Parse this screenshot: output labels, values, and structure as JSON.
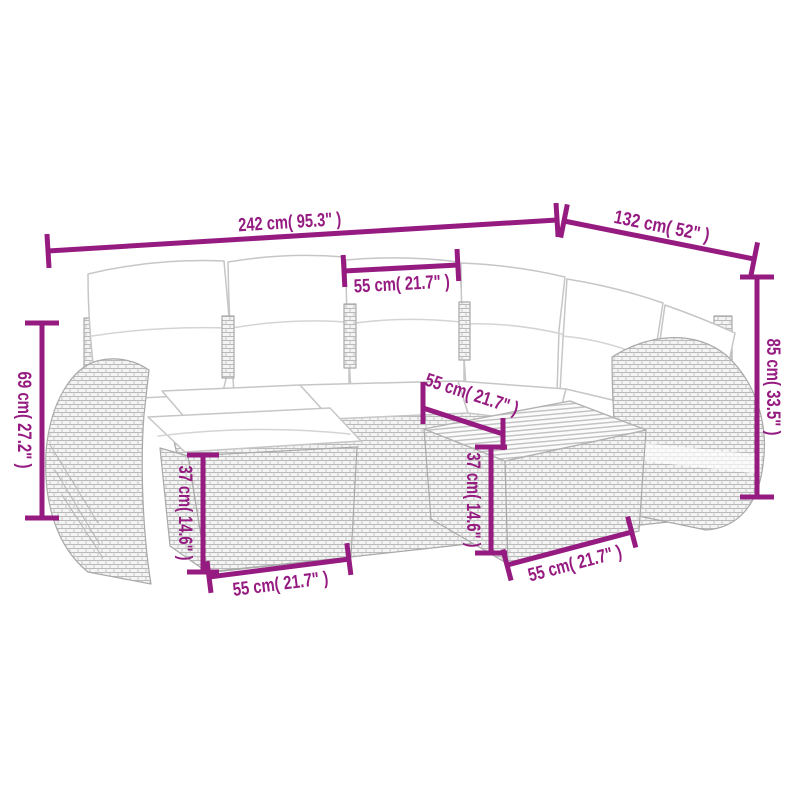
{
  "diagram": {
    "type": "product-dimension-diagram",
    "background": "#ffffff",
    "accent_color": "#951B81",
    "line_art_color": "#bcbcbc",
    "product_parts": [
      "corner-sofa",
      "back-cushions",
      "seat-cushions",
      "left-armrest",
      "right-armrest",
      "footstool-with-cushion",
      "coffee-table-slatted-top"
    ],
    "dimensions": {
      "total_width": "242 cm( 95.3\" )",
      "total_depth": "132 cm( 52\" )",
      "seat_width": "55 cm( 21.7\" )",
      "left_arm_height": "69 cm( 27.2\" )",
      "back_height": "85 cm( 33.5\" )",
      "footstool_height": "37 cm( 14.6\" )",
      "footstool_width": "55 cm( 21.7\" )",
      "table_depth": "55 cm( 21.7\" )",
      "table_height": "37 cm( 14.6\" )",
      "table_width": "55 cm( 21.7\" )"
    }
  }
}
